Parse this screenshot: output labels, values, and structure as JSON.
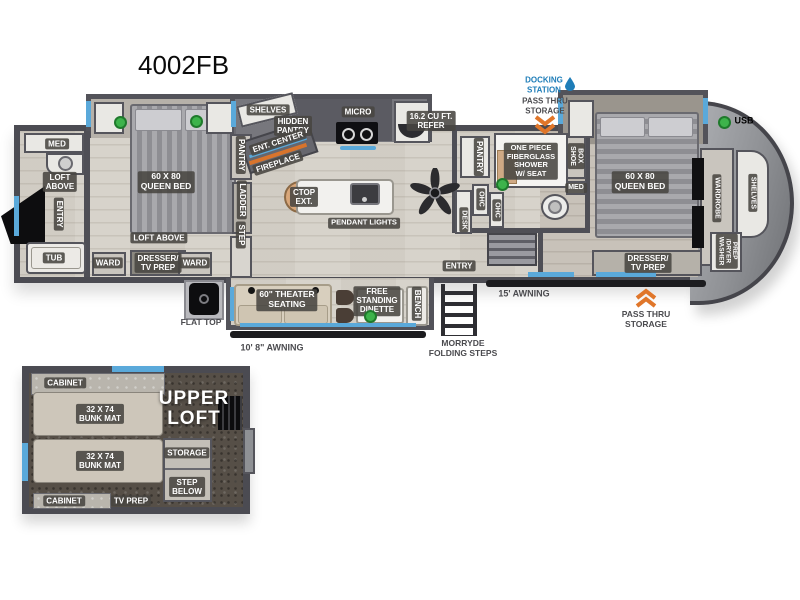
{
  "title": "4002FB",
  "legend": {
    "usb_label": "USB"
  },
  "callouts": {
    "docking_station": "DOCKING\nSTATION",
    "pass_thru_top": "PASS THRU\nSTORAGE",
    "pass_thru_bottom": "PASS THRU\nSTORAGE",
    "awning_left": "10' 8\" AWNING",
    "awning_right": "15' AWNING",
    "flat_top": "FLAT TOP",
    "folding_steps": "MORRYDE\nFOLDING STEPS"
  },
  "rear_bath": {
    "med": "MED",
    "loft_above": "LOFT\nABOVE",
    "entry": "ENTRY",
    "tub": "TUB"
  },
  "rear_bedroom": {
    "bed": "60 X 80\nQUEEN BED",
    "loft_above": "LOFT ABOVE",
    "ward_left": "WARD",
    "dresser_tv": "DRESSER/\nTV PREP",
    "ward_right": "WARD"
  },
  "galley_wall": {
    "pantry": "PANTRY",
    "ladder": "LADDER",
    "step": "STEP"
  },
  "kitchen": {
    "shelves": "SHELVES",
    "hidden_pantry": "HIDDEN\nPANTRY",
    "ent_center": "ENT. CENTER",
    "fireplace": "FIREPLACE",
    "micro": "MICRO",
    "refer": "16.2 CU FT.\nREFER",
    "ctop_ext": "CTOP\nEXT.",
    "pendant_lights": "PENDANT LIGHTS"
  },
  "living": {
    "theater": "60\" THEATER\nSEATING",
    "dinette": "FREE\nSTANDING\nDINETTE",
    "bench": "BENCH",
    "entry": "ENTRY"
  },
  "mid_bath": {
    "pantry": "PANTRY",
    "shower": "ONE PIECE\nFIBERGLASS\nSHOWER\nW/ SEAT",
    "shoe_box": "SHOE\nBOX",
    "med": "MED",
    "ohc_a": "OHC",
    "ohc_b": "OHC",
    "desk": "DESK"
  },
  "front_bedroom": {
    "bed": "60 X 80\nQUEEN BED",
    "dresser_tv": "DRESSER/\nTV PREP",
    "wardrobe": "WARDROBE",
    "shelves": "SHELVES",
    "washer_dryer": "WASHER\n/DRYER\nPREP"
  },
  "loft": {
    "cabinet_top": "CABINET",
    "bunk_a": "32 X 74\nBUNK MAT",
    "bunk_b": "32 X 74\nBUNK MAT",
    "upper_loft": "UPPER\nLOFT",
    "storage": "STORAGE",
    "step_below": "STEP\nBELOW",
    "cabinet_bottom": "CABINET",
    "tv_prep": "TV PREP"
  },
  "colors": {
    "accent_blue": "#5aa9da",
    "docking_blue": "#1e7db8",
    "chevron_orange": "#e0762a",
    "usb_green": "#3db34b"
  }
}
